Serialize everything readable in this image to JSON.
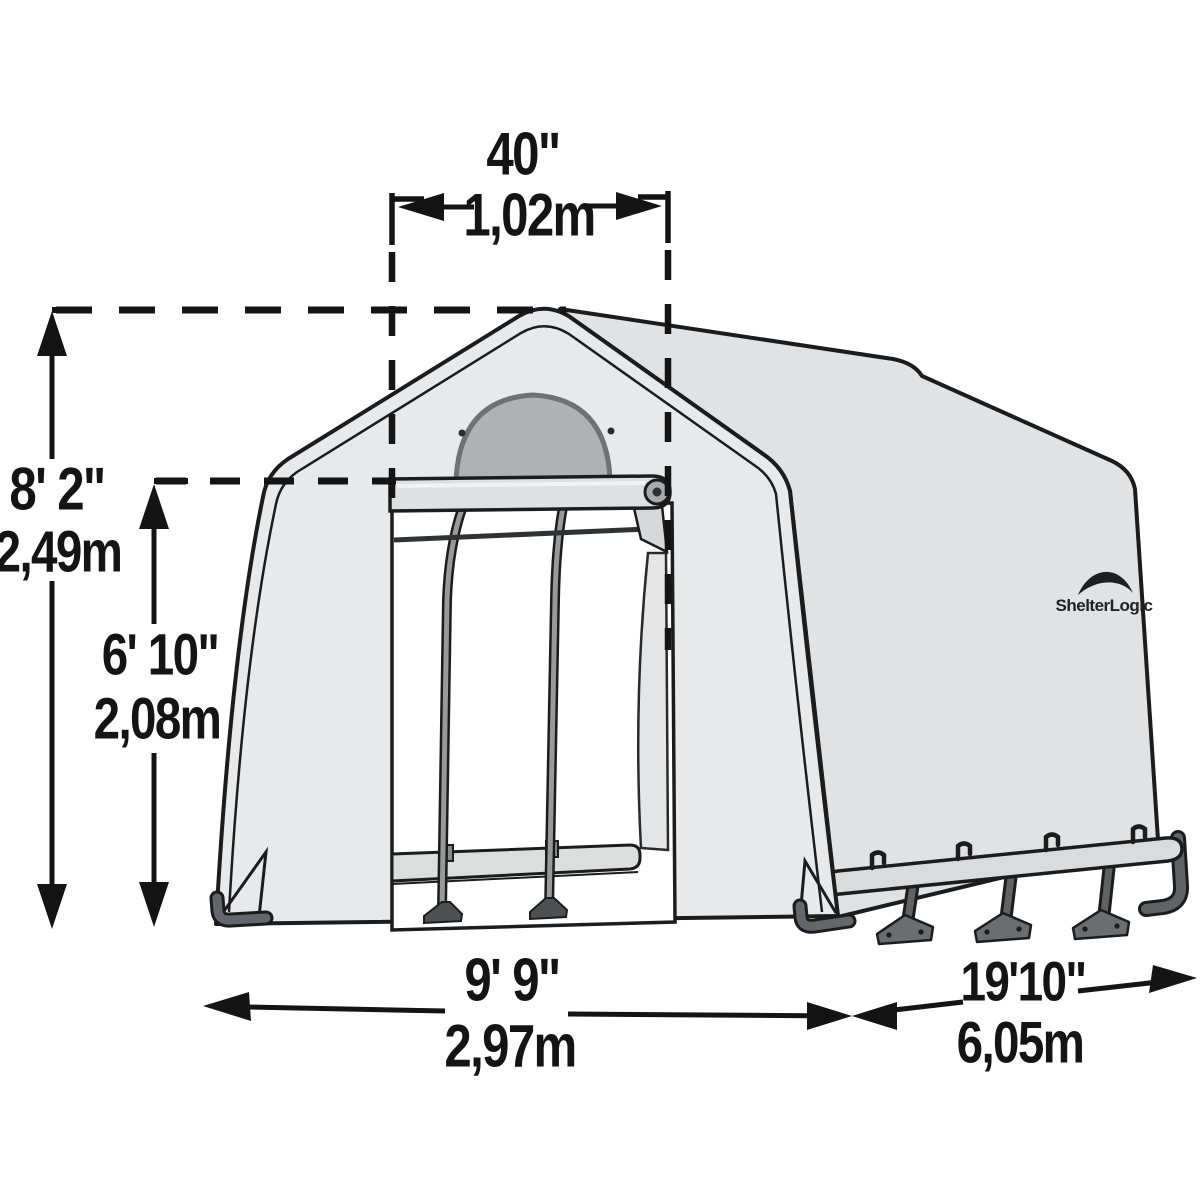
{
  "brand": {
    "logo_text": "ShelterLogic"
  },
  "dimensions": {
    "door_width": {
      "imperial": "40\"",
      "metric": "1,02m"
    },
    "peak_height": {
      "imperial": "8' 2\"",
      "metric": "2,49m"
    },
    "door_height": {
      "imperial": "6' 10\"",
      "metric": "2,08m"
    },
    "front_width": {
      "imperial": "9' 9\"",
      "metric": "2,97m"
    },
    "side_length": {
      "imperial": "19'10\"",
      "metric": "6,05m"
    }
  },
  "colors": {
    "line": "#141414",
    "fabric_front": "#e8e9ea",
    "fabric_side": "#e1e2e3",
    "window": "#afb2b4",
    "hardware": "#63666a",
    "background": "#ffffff"
  }
}
